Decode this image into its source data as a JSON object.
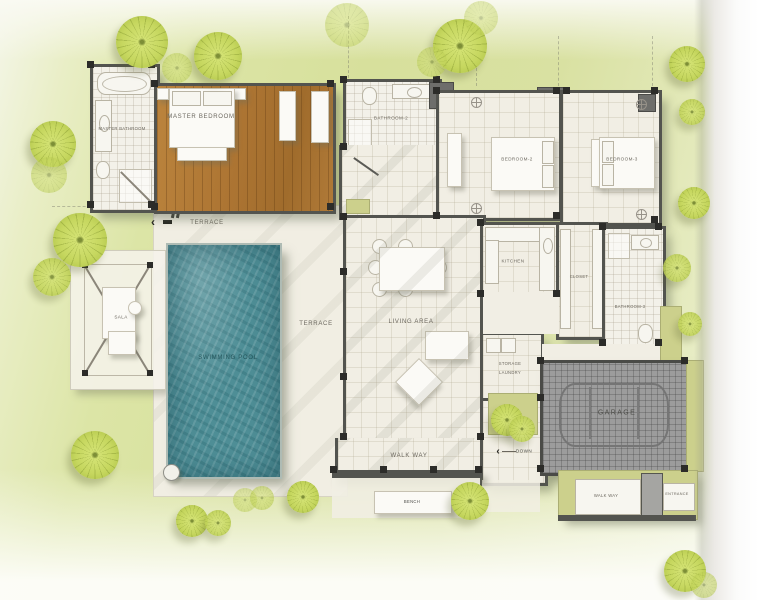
{
  "labels": {
    "master_bedroom": "MASTER BEDROOM",
    "master_bathroom": "MASTER BATHROOM",
    "bathroom_2": "BATHROOM-2",
    "bedroom_2": "BEDROOM-2",
    "bedroom_3": "BEDROOM-3",
    "terrace": "TERRACE",
    "sala": "SALA",
    "swimming_pool": "SWIMMING POOL",
    "living_area": "LIVING AREA",
    "kitchen": "KITCHEN",
    "closet": "CLOSET",
    "bathroom_3": "BATHROOM-3",
    "storage": "STORAGE",
    "laundry": "LAUNDRY",
    "garage": "GARAGE",
    "walk_way": "WALK WAY",
    "down": "DOWN",
    "bench": "BENCH",
    "entrance": "ENTRANCE"
  },
  "colors": {
    "lawn": "#d7e09c",
    "pool_water": "#4e8e96",
    "wood_floor": "#ad7533",
    "garage_floor": "#9c9c9c",
    "wall": "#53544f",
    "foliage": "#c6d75f",
    "khaki_path": "#ccd08c",
    "floor_cream": "#f1eee4"
  }
}
